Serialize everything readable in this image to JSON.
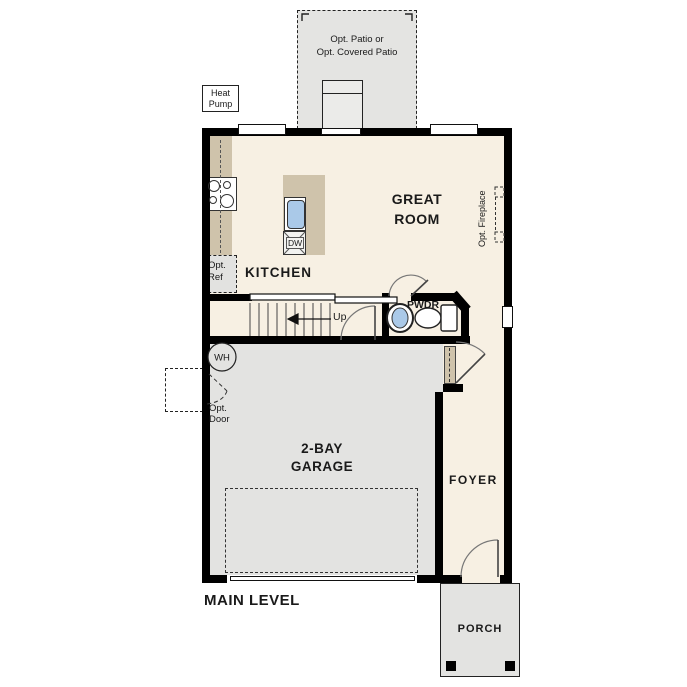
{
  "plan_title": "MAIN LEVEL",
  "rooms": {
    "great_room": [
      "GREAT",
      "ROOM"
    ],
    "kitchen": "KITCHEN",
    "powder": "PWDR",
    "foyer": "FOYER",
    "garage": [
      "2-BAY",
      "GARAGE"
    ],
    "porch": "PORCH"
  },
  "annotations": {
    "patio": [
      "Opt. Patio or",
      "Opt. Covered Patio"
    ],
    "heat_pump": [
      "Heat",
      "Pump"
    ],
    "opt_ref": [
      "Opt.",
      "Ref"
    ],
    "opt_door": [
      "Opt.",
      "Door"
    ],
    "opt_fireplace": "Opt. Fireplace",
    "stairs_up": "Up",
    "water_heater": "WH",
    "dishwasher": "DW"
  },
  "colors": {
    "floor": "#f7f0e3",
    "garage_floor": "#e3e3e1",
    "patio_floor": "#e4e4e2",
    "counter": "#cfc3ab",
    "sink": "#aac9e8",
    "wall": "#000000",
    "text": "#1a1a1a"
  }
}
